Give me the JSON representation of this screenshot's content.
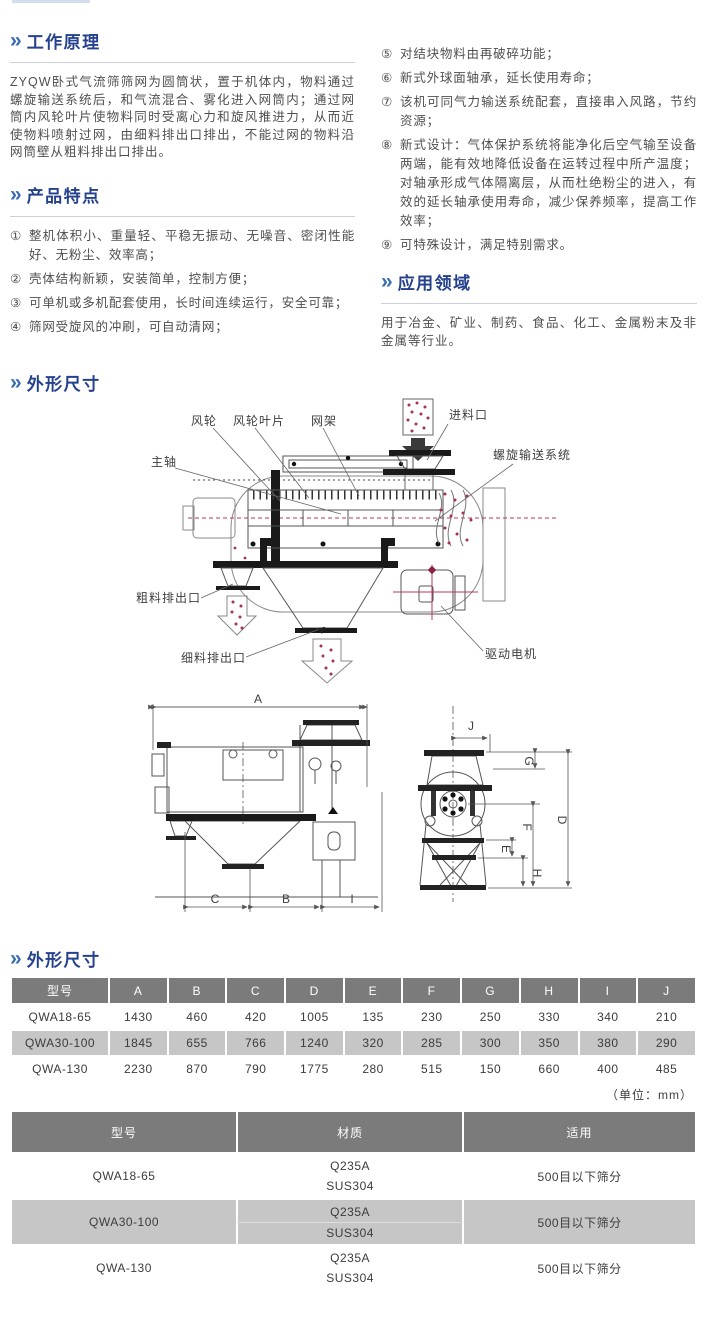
{
  "headings": {
    "chevron": "»",
    "working_principle": "工作原理",
    "features": "产品特点",
    "application": "应用领域",
    "dimensions": "外形尺寸",
    "dimensions2": "外形尺寸"
  },
  "working_principle": {
    "body": "ZYQW卧式气流筛筛网为圆筒状，置于机体内，物料通过螺旋输送系统后，和气流混合、雾化进入网筒内；通过网筒内风轮叶片使物料同时受离心力和旋风推进力，从而近使物料喷射过网，由细料排出口排出，不能过网的物料沿网筒壁从粗料排出口排出。"
  },
  "features": {
    "left": [
      {
        "num": "①",
        "text": "整机体积小、重量轻、平稳无振动、无噪音、密闭性能好、无粉尘、效率高；"
      },
      {
        "num": "②",
        "text": "壳体结构新颖，安装简单，控制方便；"
      },
      {
        "num": "③",
        "text": "可单机或多机配套使用，长时间连续运行，安全可靠；"
      },
      {
        "num": "④",
        "text": "筛网受旋风的冲刷，可自动清网；"
      }
    ],
    "right": [
      {
        "num": "⑤",
        "text": "对结块物料由再破碎功能；"
      },
      {
        "num": "⑥",
        "text": "新式外球面轴承，延长使用寿命；"
      },
      {
        "num": "⑦",
        "text": "该机可同气力输送系统配套，直接串入风路，节约资源；"
      },
      {
        "num": "⑧",
        "text": "新式设计：气体保护系统将能净化后空气输至设备两端，能有效地降低设备在运转过程中所产温度；对轴承形成气体隔离层，从而杜绝粉尘的进入，有效的延长轴承使用寿命，减少保养频率，提高工作效率；"
      },
      {
        "num": "⑨",
        "text": "可特殊设计，满足特别需求。"
      }
    ]
  },
  "application": {
    "body": "用于冶金、矿业、制药、食品、化工、金属粉末及非金属等行业。"
  },
  "diagram": {
    "labels": {
      "main_shaft": "主轴",
      "wind_wheel": "风轮",
      "wind_blade": "风轮叶片",
      "mesh_frame": "网架",
      "inlet": "进料口",
      "screw_system": "螺旋输送系统",
      "coarse_outlet": "粗料排出口",
      "fine_outlet": "细料排出口",
      "drive_motor": "驱动电机"
    }
  },
  "dim_letters": {
    "A": "A",
    "B": "B",
    "C": "C",
    "D": "D",
    "E": "E",
    "F": "F",
    "G": "G",
    "H": "H",
    "I": "I",
    "J": "J"
  },
  "dim_table": {
    "headers": [
      "型号",
      "A",
      "B",
      "C",
      "D",
      "E",
      "F",
      "G",
      "H",
      "I",
      "J"
    ],
    "rows": [
      {
        "model": "QWA18-65",
        "values": [
          "1430",
          "460",
          "420",
          "1005",
          "135",
          "230",
          "250",
          "330",
          "340",
          "210"
        ]
      },
      {
        "model": "QWA30-100",
        "values": [
          "1845",
          "655",
          "766",
          "1240",
          "320",
          "285",
          "300",
          "350",
          "380",
          "290"
        ]
      },
      {
        "model": "QWA-130",
        "values": [
          "2230",
          "870",
          "790",
          "1775",
          "280",
          "515",
          "150",
          "660",
          "400",
          "485"
        ]
      }
    ],
    "unit_note": "（单位：mm）"
  },
  "material_table": {
    "headers": [
      "型号",
      "材质",
      "适用"
    ],
    "rows": [
      {
        "model": "QWA18-65",
        "materials": [
          "Q235A",
          "SUS304"
        ],
        "application": "500目以下筛分"
      },
      {
        "model": "QWA30-100",
        "materials": [
          "Q235A",
          "SUS304"
        ],
        "application": "500目以下筛分"
      },
      {
        "model": "QWA-130",
        "materials": [
          "Q235A",
          "SUS304"
        ],
        "application": "500目以下筛分"
      }
    ]
  },
  "colors": {
    "accent_blue": "#3a6cb4",
    "heading_navy": "#25418d",
    "table_header_gray": "#7b7b7b",
    "row_shade_gray": "#c6c6c6",
    "dot_red": "#a63154"
  }
}
